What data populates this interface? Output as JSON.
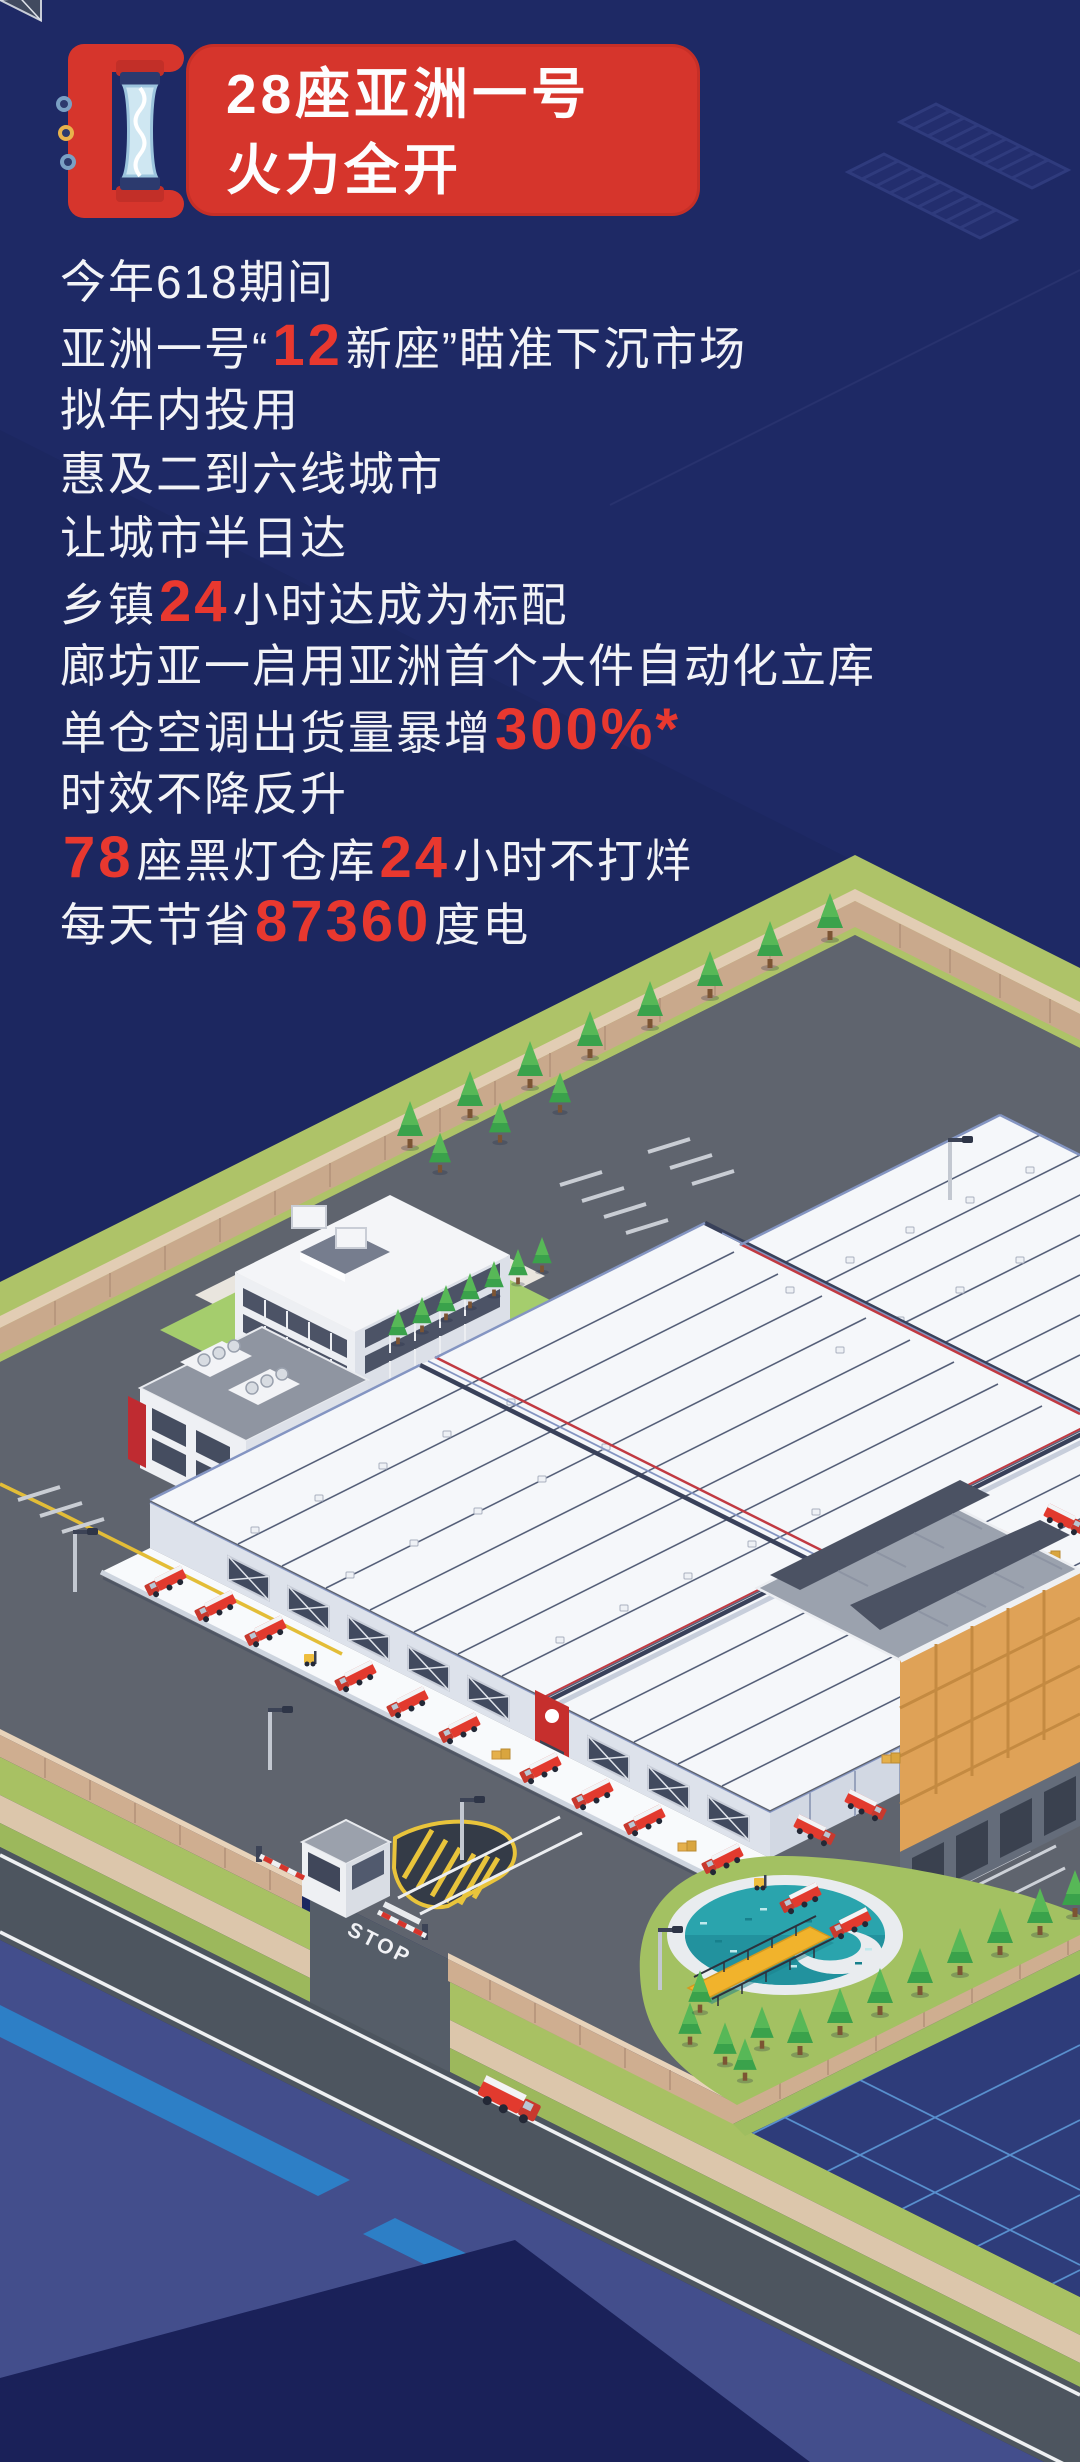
{
  "banner": {
    "title_line1": "28座亚洲一号",
    "title_line2": "火力全开",
    "background_color": "#d6352c",
    "icon": "heat-tube-icon"
  },
  "stats": {
    "text_color": "#f2f3f7",
    "highlight_color": "#e8382f",
    "lines": [
      [
        {
          "t": "今年618期间"
        }
      ],
      [
        {
          "t": "亚洲一号“"
        },
        {
          "t": "12",
          "hl": true
        },
        {
          "t": "新座”瞄准下沉市场"
        }
      ],
      [
        {
          "t": "拟年内投用"
        }
      ],
      [
        {
          "t": "惠及二到六线城市"
        }
      ],
      [
        {
          "t": "让城市半日达"
        }
      ],
      [
        {
          "t": "乡镇"
        },
        {
          "t": "24",
          "hl": true
        },
        {
          "t": "小时达成为标配"
        }
      ],
      [
        {
          "t": "廊坊亚一启用亚洲首个大件自动化立库"
        }
      ],
      [
        {
          "t": "单仓空调出货量暴增"
        },
        {
          "t": "300%*",
          "hl": true
        }
      ],
      [
        {
          "t": "时效不降反升"
        }
      ],
      [
        {
          "t": "78",
          "hl": true
        },
        {
          "t": "座黑灯仓库"
        },
        {
          "t": "24",
          "hl": true
        },
        {
          "t": "小时不打烊"
        }
      ],
      [
        {
          "t": "每天节省"
        },
        {
          "t": "87360",
          "hl": true
        },
        {
          "t": "度电"
        }
      ]
    ]
  },
  "illustration": {
    "stop_marking": "STOP",
    "theme": "isometric logistics park with warehouses, JD delivery trucks, office buildings, solar building, pond and guard gate",
    "colors": {
      "background_navy": "#1e2965",
      "asphalt": "#5f646e",
      "outer_road": "#4d555f",
      "grass": "#a8c163",
      "wall_tan": "#cfae90",
      "roof_white": "#f5f7fa",
      "roof_trim_blue": "#8495c2",
      "truck_red": "#e23a2e",
      "pond_teal": "#2aa4ad",
      "pier_yellow": "#f1b32c",
      "facade_orange": "#dfa257",
      "water_blue": "#434e8c",
      "stripe_blue": "#2d7fc6",
      "grid_field": "#2e3c7a"
    }
  }
}
